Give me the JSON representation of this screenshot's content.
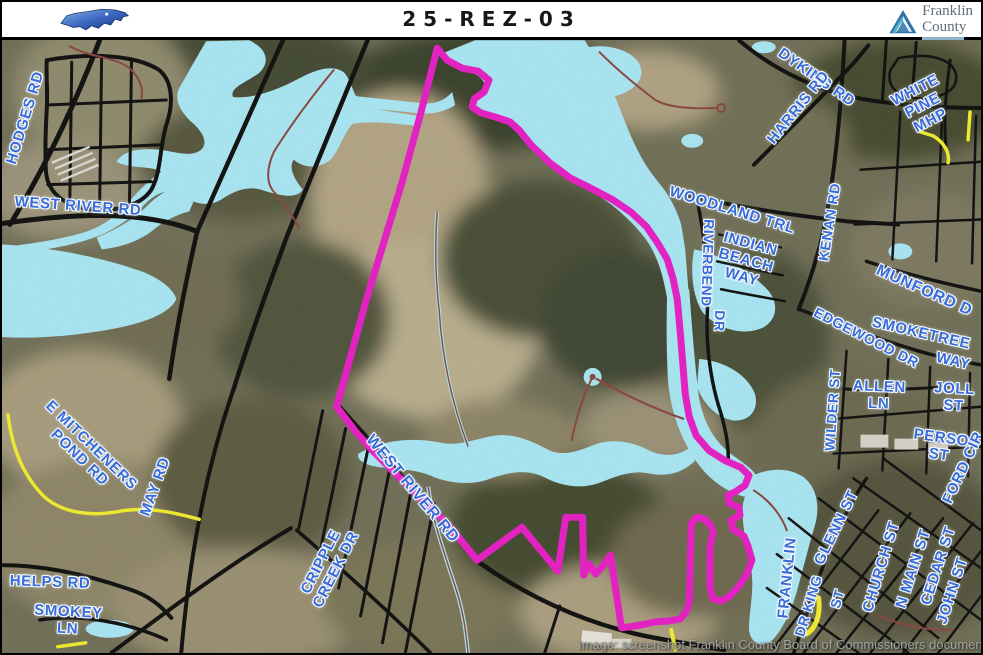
{
  "header": {
    "title": "25-REZ-03",
    "nc_logo_name": "north-carolina-state-icon",
    "county_logo": {
      "line1": "Franklin",
      "line2": "County"
    }
  },
  "map": {
    "caption": "Image: screenshot Franklin County Board of Commissioners document",
    "colors": {
      "parcel_boundary": "#e81cc6",
      "water": "#a9e8f6",
      "road_label_blue": "#3a6cd9",
      "road_black": "#0d0d0d",
      "road_yellow": "#f2ee2c",
      "road_minor_red": "#8a4440"
    },
    "parcel_case_number": "25-REZ-03",
    "road_labels": [
      {
        "lines": [
          "HODGES RD"
        ],
        "x": 24,
        "y": 118,
        "rot": -73,
        "size": 15
      },
      {
        "lines": [
          "WEST RIVER RD"
        ],
        "x": 76,
        "y": 207,
        "rot": 4,
        "size": 15
      },
      {
        "lines": [
          "E MITCHENERS",
          "POND RD"
        ],
        "x": 83,
        "y": 452,
        "rot": 44,
        "size": 15
      },
      {
        "lines": [
          "MAY RD"
        ],
        "x": 154,
        "y": 487,
        "rot": -70,
        "size": 15
      },
      {
        "lines": [
          "HELPS RD"
        ],
        "x": 48,
        "y": 583,
        "rot": 2,
        "size": 15
      },
      {
        "lines": [
          "SMOKEY",
          "LN"
        ],
        "x": 66,
        "y": 621,
        "rot": 3,
        "size": 15
      },
      {
        "lines": [
          "CRIPPLE",
          "CREEK DR"
        ],
        "x": 327,
        "y": 566,
        "rot": -63,
        "size": 15
      },
      {
        "lines": [
          "WEST RIVER RD"
        ],
        "x": 410,
        "y": 489,
        "rot": 50,
        "size": 16
      },
      {
        "lines": [
          "DYKING RD"
        ],
        "x": 814,
        "y": 78,
        "rot": 35,
        "size": 15
      },
      {
        "lines": [
          "HARRIS RD"
        ],
        "x": 797,
        "y": 108,
        "rot": -51,
        "size": 15
      },
      {
        "lines": [
          "WHITE",
          "PINE",
          "MHP"
        ],
        "x": 921,
        "y": 106,
        "rot": -27,
        "size": 15
      },
      {
        "lines": [
          "WOODLAND TRL"
        ],
        "x": 730,
        "y": 211,
        "rot": 17,
        "size": 15
      },
      {
        "lines": [
          "INDIAN",
          "BEACH",
          "WAY"
        ],
        "x": 744,
        "y": 261,
        "rot": 15,
        "size": 15
      },
      {
        "lines": [
          "RIVERBEND"
        ],
        "x": 705,
        "y": 263,
        "rot": 92,
        "size": 14
      },
      {
        "lines": [
          "DR"
        ],
        "x": 717,
        "y": 321,
        "rot": 92,
        "size": 14
      },
      {
        "lines": [
          "KENAN RD"
        ],
        "x": 828,
        "y": 222,
        "rot": -81,
        "size": 14
      },
      {
        "lines": [
          "MUNFORD D"
        ],
        "x": 922,
        "y": 291,
        "rot": 24,
        "size": 16
      },
      {
        "lines": [
          "EDGEWOOD DR"
        ],
        "x": 864,
        "y": 338,
        "rot": 27,
        "size": 14
      },
      {
        "lines": [
          "SMOKETREE"
        ],
        "x": 919,
        "y": 334,
        "rot": 13,
        "size": 15
      },
      {
        "lines": [
          "WAY"
        ],
        "x": 951,
        "y": 362,
        "rot": 13,
        "size": 15
      },
      {
        "lines": [
          "ALLEN",
          "LN"
        ],
        "x": 877,
        "y": 396,
        "rot": 2,
        "size": 15
      },
      {
        "lines": [
          "JOLL",
          "ST"
        ],
        "x": 952,
        "y": 398,
        "rot": 3,
        "size": 15
      },
      {
        "lines": [
          "PERSO",
          "ST"
        ],
        "x": 938,
        "y": 447,
        "rot": 8,
        "size": 15
      },
      {
        "lines": [
          "WILDER ST"
        ],
        "x": 831,
        "y": 410,
        "rot": -86,
        "size": 14
      },
      {
        "lines": [
          "GLENN ST"
        ],
        "x": 835,
        "y": 528,
        "rot": -64,
        "size": 15
      },
      {
        "lines": [
          "FRANKLIN"
        ],
        "x": 786,
        "y": 578,
        "rot": -84,
        "size": 15
      },
      {
        "lines": [
          "DR KING"
        ],
        "x": 807,
        "y": 606,
        "rot": -73,
        "size": 14
      },
      {
        "lines": [
          "ST"
        ],
        "x": 836,
        "y": 599,
        "rot": -73,
        "size": 14
      },
      {
        "lines": [
          "CHURCH ST"
        ],
        "x": 880,
        "y": 567,
        "rot": -73,
        "size": 15
      },
      {
        "lines": [
          "N MAIN ST"
        ],
        "x": 912,
        "y": 569,
        "rot": -72,
        "size": 15
      },
      {
        "lines": [
          "CEDAR ST"
        ],
        "x": 937,
        "y": 566,
        "rot": -72,
        "size": 15
      },
      {
        "lines": [
          "JOHN ST"
        ],
        "x": 951,
        "y": 591,
        "rot": -72,
        "size": 15
      },
      {
        "lines": [
          "FORD CIR"
        ],
        "x": 962,
        "y": 468,
        "rot": -65,
        "size": 15
      }
    ]
  }
}
